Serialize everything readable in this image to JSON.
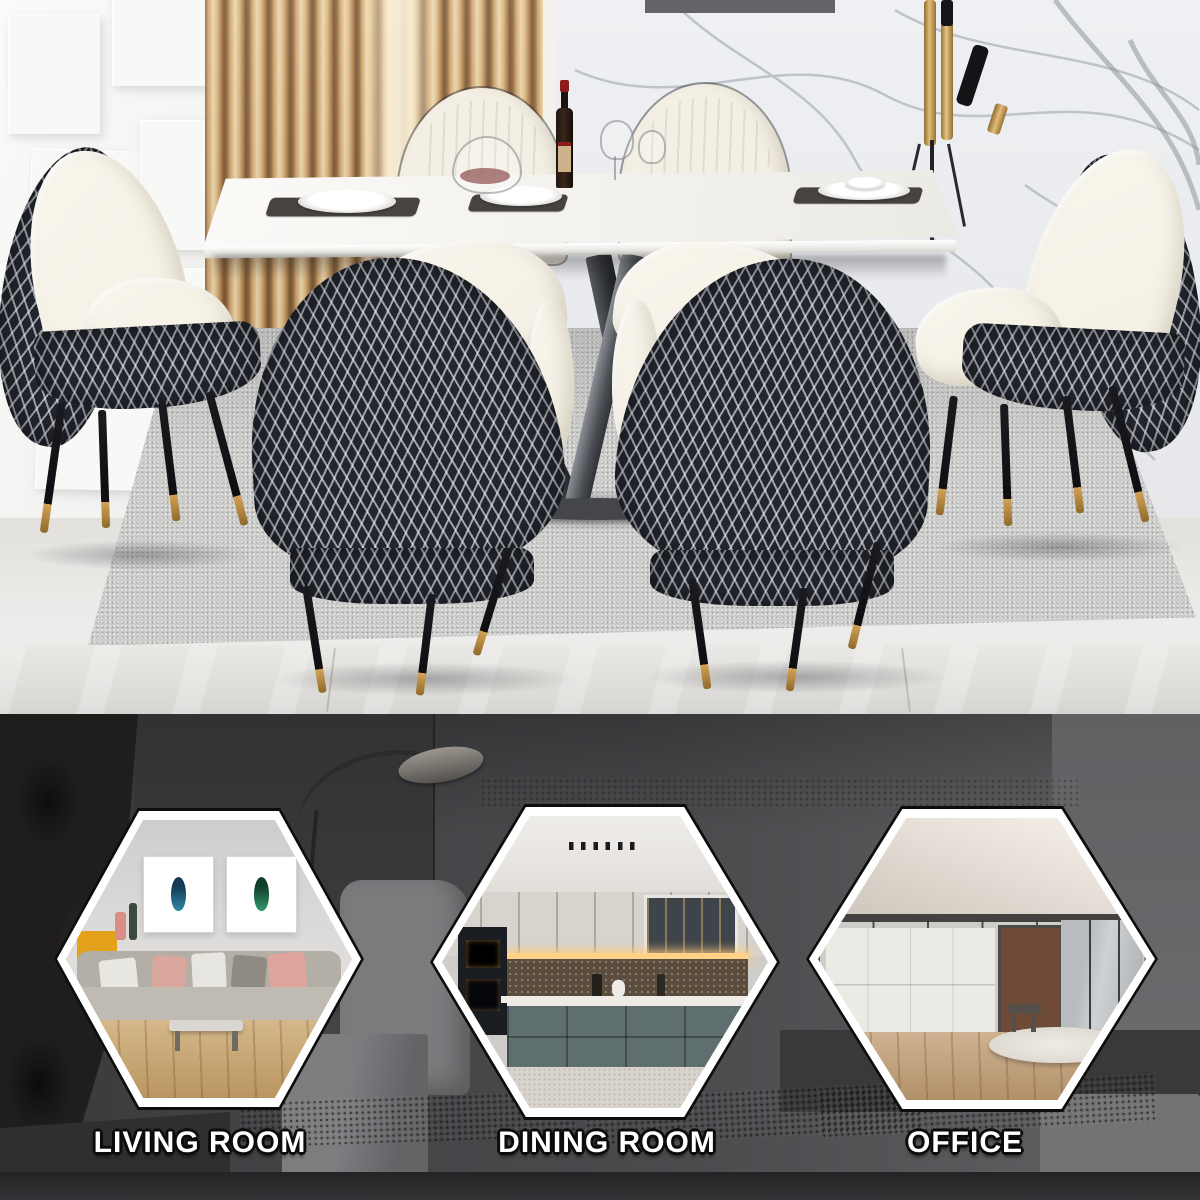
{
  "banner": {
    "categories": [
      {
        "id": "living-room",
        "label": "LIVING ROOM"
      },
      {
        "id": "dining-room",
        "label": "DINING ROOM"
      },
      {
        "id": "office",
        "label": "OFFICE"
      }
    ]
  },
  "theme": {
    "gold": "#c0924c",
    "chair_dark": "#23262e",
    "chair_cream": "#f3efe4",
    "accent_yellow": "#e4a11c",
    "bottom_bg": "#47474a",
    "hex_border": "#ffffff",
    "label_color": "#ffffff",
    "label_outline": "#0c0c0c",
    "marble_wall": "#eceef1",
    "wood_slat": "#d9b47e"
  }
}
